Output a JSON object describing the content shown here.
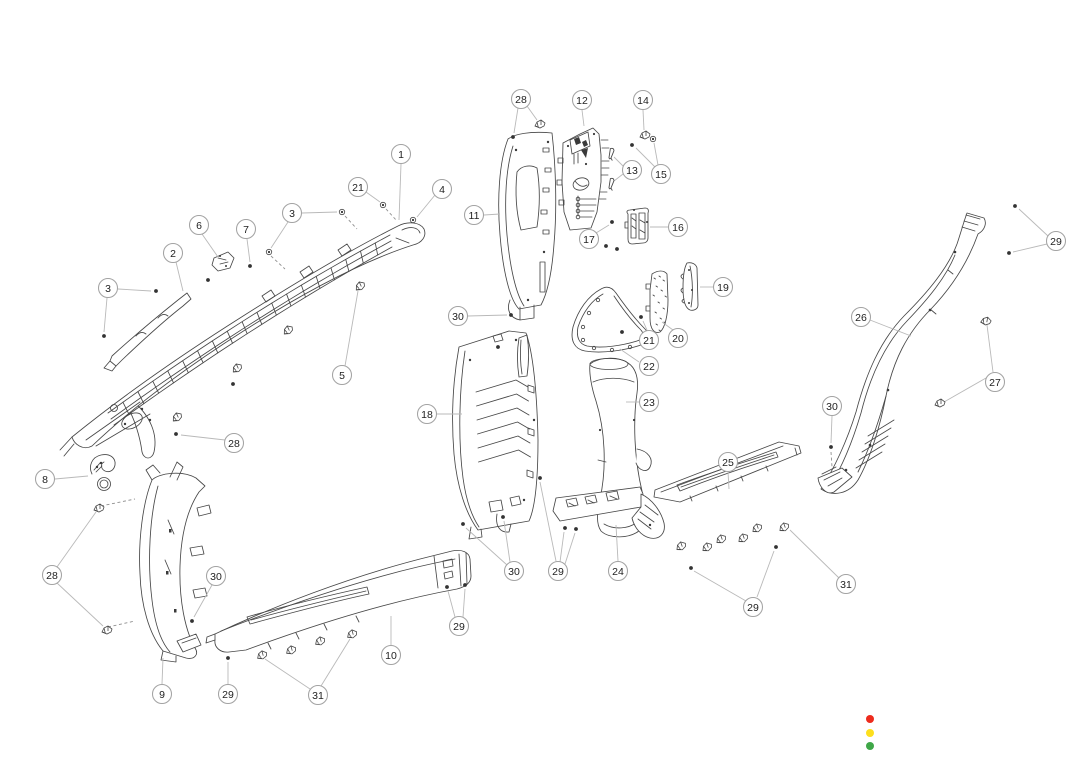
{
  "diagram": {
    "type": "exploded-parts-diagram",
    "style": {
      "callout_radius": 9.5,
      "part_line_color": "#474747",
      "leader_color": "#b9b9b9",
      "dash_color": "#8f8f8f",
      "callout_stroke": "#a3a3a3",
      "callout_text_color": "#222222"
    },
    "callouts": [
      {
        "label": "1",
        "x": 401,
        "y": 154,
        "leaders": [
          [
            401,
            164,
            399,
            220
          ]
        ]
      },
      {
        "label": "21",
        "x": 358,
        "y": 187,
        "leaders": [
          [
            366,
            192,
            380,
            202
          ]
        ]
      },
      {
        "label": "4",
        "x": 442,
        "y": 189,
        "leaders": [
          [
            435,
            195,
            417,
            217
          ]
        ]
      },
      {
        "label": "3",
        "x": 292,
        "y": 213,
        "leaders": [
          [
            288,
            222,
            271,
            248
          ],
          [
            302,
            213,
            337,
            212
          ]
        ]
      },
      {
        "label": "6",
        "x": 199,
        "y": 225,
        "leaders": [
          [
            202,
            234,
            218,
            257
          ]
        ]
      },
      {
        "label": "7",
        "x": 246,
        "y": 229,
        "leaders": [
          [
            247,
            239,
            250,
            262
          ]
        ]
      },
      {
        "label": "2",
        "x": 173,
        "y": 253,
        "leaders": [
          [
            176,
            262,
            183,
            291
          ]
        ]
      },
      {
        "label": "3",
        "x": 108,
        "y": 288,
        "leaders": [
          [
            118,
            289,
            151,
            291
          ],
          [
            107,
            298,
            104,
            332
          ]
        ]
      },
      {
        "label": "5",
        "x": 342,
        "y": 375,
        "leaders": [
          [
            345,
            366,
            358,
            291
          ]
        ]
      },
      {
        "label": "28",
        "x": 234,
        "y": 443,
        "leaders": [
          [
            225,
            440,
            181,
            435
          ]
        ]
      },
      {
        "label": "8",
        "x": 45,
        "y": 479,
        "leaders": [
          [
            55,
            479,
            88,
            476
          ]
        ]
      },
      {
        "label": "28",
        "x": 52,
        "y": 575,
        "leaders": [
          [
            57,
            567,
            96,
            512
          ],
          [
            57,
            583,
            103,
            626
          ]
        ]
      },
      {
        "label": "30",
        "x": 216,
        "y": 576,
        "leaders": [
          [
            212,
            585,
            194,
            617
          ]
        ]
      },
      {
        "label": "9",
        "x": 162,
        "y": 694,
        "leaders": [
          [
            162,
            684,
            163,
            658
          ]
        ]
      },
      {
        "label": "29",
        "x": 228,
        "y": 694,
        "leaders": [
          [
            228,
            684,
            228,
            662
          ]
        ]
      },
      {
        "label": "31",
        "x": 318,
        "y": 695,
        "leaders": [
          [
            310,
            689,
            265,
            659
          ],
          [
            321,
            686,
            350,
            639
          ]
        ]
      },
      {
        "label": "10",
        "x": 391,
        "y": 655,
        "leaders": [
          [
            391,
            645,
            391,
            616
          ]
        ]
      },
      {
        "label": "29",
        "x": 459,
        "y": 626,
        "leaders": [
          [
            455,
            617,
            448,
            591
          ],
          [
            463,
            617,
            465,
            589
          ]
        ]
      },
      {
        "label": "28",
        "x": 521,
        "y": 99,
        "leaders": [
          [
            527,
            106,
            537,
            120
          ],
          [
            518,
            108,
            514,
            133
          ]
        ]
      },
      {
        "label": "12",
        "x": 582,
        "y": 100,
        "leaders": [
          [
            582,
            110,
            584,
            126
          ]
        ]
      },
      {
        "label": "14",
        "x": 643,
        "y": 100,
        "leaders": [
          [
            643,
            110,
            644,
            130
          ]
        ]
      },
      {
        "label": "13",
        "x": 632,
        "y": 170,
        "leaders": [
          [
            623,
            166,
            614,
            157
          ],
          [
            623,
            174,
            614,
            181
          ]
        ]
      },
      {
        "label": "15",
        "x": 661,
        "y": 174,
        "leaders": [
          [
            655,
            167,
            636,
            148
          ],
          [
            658,
            165,
            654,
            143
          ]
        ]
      },
      {
        "label": "11",
        "x": 474,
        "y": 215,
        "leaders": [
          [
            484,
            215,
            500,
            214
          ]
        ]
      },
      {
        "label": "17",
        "x": 589,
        "y": 239,
        "leaders": [
          [
            596,
            233,
            609,
            225
          ]
        ]
      },
      {
        "label": "16",
        "x": 678,
        "y": 227,
        "leaders": [
          [
            668,
            227,
            650,
            227
          ]
        ]
      },
      {
        "label": "19",
        "x": 723,
        "y": 287,
        "leaders": [
          [
            713,
            287,
            700,
            287
          ]
        ]
      },
      {
        "label": "20",
        "x": 678,
        "y": 338,
        "leaders": [
          [
            673,
            330,
            662,
            322
          ]
        ]
      },
      {
        "label": "21",
        "x": 649,
        "y": 340,
        "leaders": [
          [
            647,
            330,
            643,
            321
          ]
        ]
      },
      {
        "label": "22",
        "x": 649,
        "y": 366,
        "leaders": [
          [
            639,
            362,
            620,
            349
          ]
        ]
      },
      {
        "label": "23",
        "x": 649,
        "y": 402,
        "leaders": [
          [
            639,
            402,
            626,
            402
          ]
        ]
      },
      {
        "label": "30",
        "x": 458,
        "y": 316,
        "leaders": [
          [
            468,
            316,
            507,
            315
          ]
        ]
      },
      {
        "label": "18",
        "x": 427,
        "y": 414,
        "leaders": [
          [
            437,
            414,
            462,
            414
          ]
        ]
      },
      {
        "label": "30",
        "x": 514,
        "y": 571,
        "leaders": [
          [
            510,
            562,
            504,
            521
          ],
          [
            507,
            565,
            466,
            528
          ]
        ]
      },
      {
        "label": "29",
        "x": 558,
        "y": 571,
        "leaders": [
          [
            556,
            561,
            540,
            482
          ],
          [
            560,
            562,
            564,
            532
          ],
          [
            565,
            564,
            575,
            533
          ]
        ]
      },
      {
        "label": "24",
        "x": 618,
        "y": 571,
        "leaders": [
          [
            618,
            561,
            616,
            525
          ]
        ]
      },
      {
        "label": "25",
        "x": 728,
        "y": 462,
        "leaders": [
          [
            728,
            472,
            729,
            489
          ]
        ]
      },
      {
        "label": "31",
        "x": 846,
        "y": 584,
        "leaders": [
          [
            839,
            578,
            790,
            530
          ]
        ]
      },
      {
        "label": "29",
        "x": 753,
        "y": 607,
        "leaders": [
          [
            746,
            601,
            694,
            571
          ],
          [
            757,
            597,
            774,
            551
          ]
        ]
      },
      {
        "label": "26",
        "x": 861,
        "y": 317,
        "leaders": [
          [
            870,
            320,
            911,
            336
          ]
        ]
      },
      {
        "label": "29",
        "x": 1056,
        "y": 241,
        "leaders": [
          [
            1048,
            236,
            1019,
            209
          ],
          [
            1047,
            244,
            1013,
            252
          ]
        ]
      },
      {
        "label": "27",
        "x": 995,
        "y": 382,
        "leaders": [
          [
            993,
            372,
            987,
            325
          ],
          [
            986,
            378,
            944,
            402
          ]
        ]
      },
      {
        "label": "30",
        "x": 832,
        "y": 406,
        "leaders": [
          [
            832,
            416,
            831,
            443
          ]
        ]
      }
    ],
    "dashed_leaders": [
      [
        271,
        256,
        285,
        269
      ],
      [
        345,
        216,
        357,
        229
      ],
      [
        386,
        209,
        397,
        221
      ],
      [
        101,
        506,
        135,
        499
      ],
      [
        108,
        627,
        135,
        621
      ],
      [
        831,
        452,
        832,
        467
      ]
    ],
    "fasteners": [
      [
        "screw",
        176,
        434,
        0
      ],
      [
        "screw",
        250,
        266,
        0
      ],
      [
        "screw",
        104,
        336,
        0
      ],
      [
        "screw",
        156,
        291,
        0
      ],
      [
        "screw",
        192,
        621,
        0
      ],
      [
        "screw",
        228,
        658,
        0
      ],
      [
        "screw",
        447,
        587,
        0
      ],
      [
        "screw",
        465,
        585,
        0
      ],
      [
        "screw",
        511,
        315,
        0
      ],
      [
        "screw",
        503,
        517,
        0
      ],
      [
        "screw",
        463,
        524,
        0
      ],
      [
        "screw",
        540,
        478,
        0
      ],
      [
        "screw",
        565,
        528,
        0
      ],
      [
        "screw",
        576,
        529,
        0
      ],
      [
        "screw",
        691,
        568,
        0
      ],
      [
        "screw",
        776,
        547,
        0
      ],
      [
        "screw",
        1015,
        206,
        0
      ],
      [
        "screw",
        1009,
        253,
        0
      ],
      [
        "screw",
        831,
        447,
        0
      ],
      [
        "screw",
        513,
        137,
        0
      ],
      [
        "screw",
        612,
        222,
        0
      ],
      [
        "screw",
        606,
        246,
        0
      ],
      [
        "screw",
        617,
        249,
        0
      ],
      [
        "screw",
        641,
        317,
        0
      ],
      [
        "screw",
        622,
        332,
        0
      ],
      [
        "screw",
        632,
        145,
        0
      ],
      [
        "screw",
        233,
        384,
        0
      ],
      [
        "screw",
        208,
        280,
        0
      ],
      [
        "screw",
        498,
        347,
        0
      ],
      [
        "bolt",
        269,
        252,
        0
      ],
      [
        "bolt",
        342,
        212,
        0
      ],
      [
        "bolt",
        413,
        220,
        0
      ],
      [
        "bolt",
        383,
        205,
        0
      ],
      [
        "bolt",
        653,
        139,
        0
      ],
      [
        "clip",
        360,
        286,
        -25
      ],
      [
        "clip",
        288,
        330,
        -25
      ],
      [
        "clip",
        237,
        368,
        -25
      ],
      [
        "clip",
        177,
        417,
        -25
      ],
      [
        "clip",
        99,
        508,
        0
      ],
      [
        "clip",
        107,
        630,
        0
      ],
      [
        "clip",
        262,
        655,
        -15
      ],
      [
        "clip",
        291,
        650,
        -15
      ],
      [
        "clip",
        320,
        641,
        -15
      ],
      [
        "clip",
        352,
        634,
        -15
      ],
      [
        "clip",
        681,
        546,
        -20
      ],
      [
        "clip",
        707,
        547,
        -20
      ],
      [
        "clip",
        721,
        539,
        -20
      ],
      [
        "clip",
        743,
        538,
        -20
      ],
      [
        "clip",
        757,
        528,
        -20
      ],
      [
        "clip",
        784,
        527,
        -20
      ],
      [
        "clip",
        986,
        321,
        10
      ],
      [
        "clip",
        940,
        403,
        0
      ],
      [
        "clip",
        645,
        135,
        0
      ],
      [
        "clip",
        540,
        124,
        0
      ],
      [
        "pin",
        611,
        154,
        15
      ],
      [
        "pin",
        611,
        184,
        15
      ]
    ]
  },
  "legend": {
    "radius": 4,
    "dots": [
      {
        "name": "red-dot",
        "color": "#ed2b1d",
        "cx": 870,
        "cy": 719
      },
      {
        "name": "yellow-dot",
        "color": "#fddf1d",
        "cx": 870,
        "cy": 733
      },
      {
        "name": "green-dot",
        "color": "#3fa748",
        "cx": 870,
        "cy": 746
      }
    ]
  }
}
